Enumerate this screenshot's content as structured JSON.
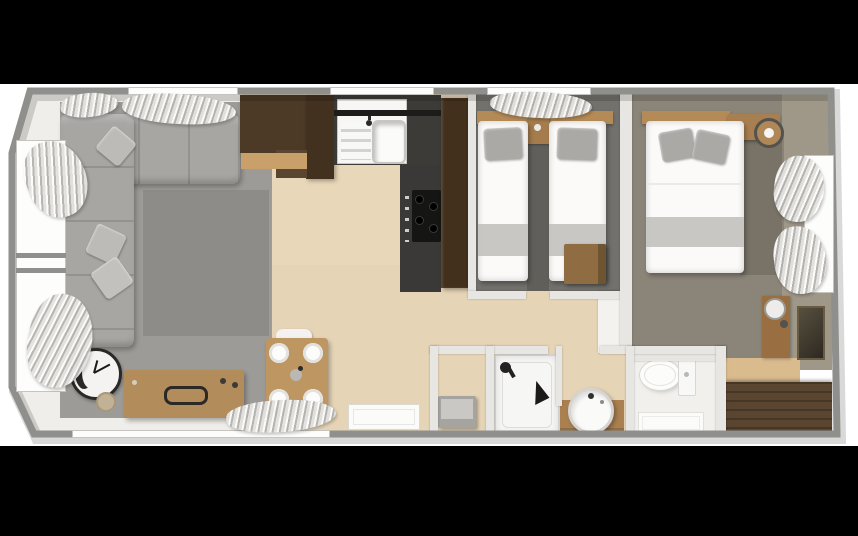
{
  "scene": {
    "type": "floor-plan",
    "style": "top-down 3D render, letterboxed on black",
    "property": "two-bedroom holiday lodge / static caravan",
    "letterbox_color": "#000000",
    "canvas_color": "#ffffff"
  },
  "palette": {
    "outer_wall": "#8f8f8c",
    "partition_wall": "#e7e6e2",
    "wood_floor": "#e8d7b9",
    "dark_cabinet_wood": "#4c3926",
    "mid_wood": "#b28c5a",
    "wardrobe_wood": "#4e3b28",
    "living_carpet": "#9c9b97",
    "living_rug": "#8d8c88",
    "twin_carpet": "#73716c",
    "master_carpet": "#8b8478",
    "worktop": "#3c3b38",
    "sofa_gray": "#a7a6a3",
    "linen_white": "#fbfaf9",
    "pillow_gray": "#aaa9a6"
  },
  "rooms": [
    {
      "id": "living-room",
      "label": "Living room",
      "furniture": [
        "corner-sofa",
        "scatter-cushions",
        "area-rug",
        "sideboard",
        "wall-clock",
        "basket",
        "dining-table-for-four",
        "curtained-windows"
      ]
    },
    {
      "id": "kitchen",
      "label": "Kitchen",
      "furniture": [
        "sink-with-drainer",
        "window",
        "overhead-cabinets",
        "worktop",
        "hob",
        "tall-fridge-unit"
      ]
    },
    {
      "id": "hallway",
      "label": "Hallway / entrance",
      "furniture": [
        "doormat"
      ]
    },
    {
      "id": "twin-bedroom",
      "label": "Twin bedroom",
      "furniture": [
        "single-bed",
        "single-bed",
        "bedside-unit",
        "storage-chest",
        "curtained-window"
      ]
    },
    {
      "id": "master-bedroom",
      "label": "Master bedroom",
      "furniture": [
        "double-bed",
        "headboard-shelf",
        "table-lamp",
        "dressing-table",
        "wall-mirror",
        "wardrobe",
        "curtained-window"
      ]
    },
    {
      "id": "shower-room",
      "label": "Shower room",
      "furniture": [
        "bench",
        "shower-cubicle",
        "washbasin-vanity"
      ]
    },
    {
      "id": "wc",
      "label": "WC",
      "furniture": [
        "toilet",
        "bath-mat"
      ]
    }
  ]
}
